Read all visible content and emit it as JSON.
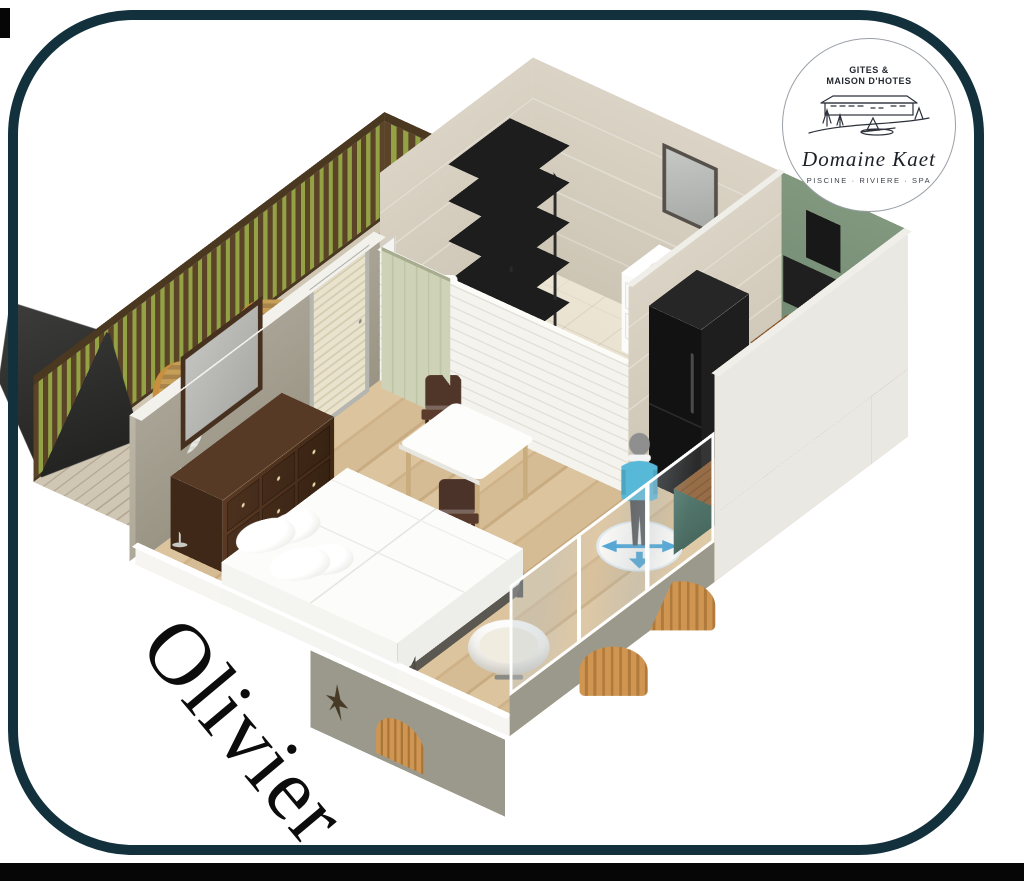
{
  "room_label": "Olivier",
  "logo": {
    "line1": "GITES &",
    "line2": "MAISON D'HOTES",
    "name": "Domaine Kaet",
    "tagline": "PISCINE · RIVIERE · SPA"
  },
  "icons": {
    "move_ring": "move-arrows-icon",
    "avatar": "person-figure"
  },
  "scene_areas": [
    "terrace",
    "bedroom",
    "bathroom",
    "kitchen",
    "dining"
  ],
  "colors": {
    "frame_border": "#12313c",
    "bottom_bar": "#060606",
    "floor_wood": "#d8bf9a",
    "floor_tile": "#ebe4d3",
    "deck_wood": "#c9bfae",
    "wall_taupe": "#a49e8f",
    "wall_tile": "#d7d0c1",
    "wall_green": "#7e9681",
    "wall_white": "#f4f3ee",
    "cabinet_teal": "#3e675c",
    "counter_wood": "#84582e",
    "appliance_black": "#161616",
    "fence_brown": "#5a4327",
    "fence_green": "#93a244",
    "barn_door": "#ccd1b6",
    "bed_white": "#fcfcfa",
    "dresser_wood": "#4e3322",
    "fixture_gold": "#c9a23f",
    "avatar_blue": "#58b9d9",
    "ring_blue": "#3f9fd4",
    "exterior_olive": "#9b998c"
  }
}
